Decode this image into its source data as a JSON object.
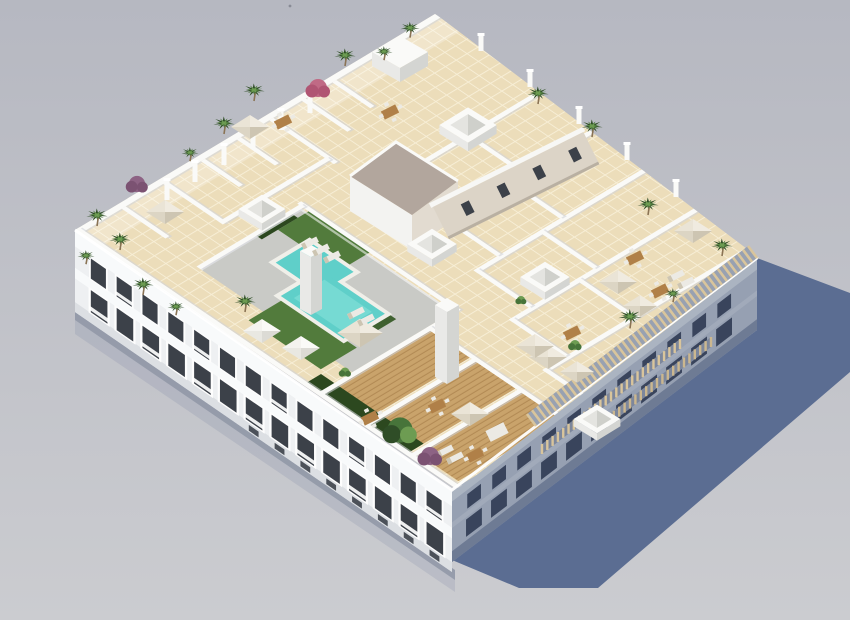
{
  "scene": {
    "title": "Aerial 3D architectural rendering of a white apartment building with rooftop terraces, swimming pool, lawns, palm trees and parasols casting a long shadow",
    "view": "isometric aerial",
    "building_type": "residential apartment block with rooftop pool deck"
  },
  "colors": {
    "bg_top": "#b6b8c1",
    "bg_bottom": "#cbccd0",
    "shadow": "#5b6d92",
    "contact_shadow": "#8f96a6",
    "facade_white": "#eef0f2",
    "facade_band": "#f8fafb",
    "facade_low": "#dcdfe3",
    "window_dark": "#3c4149",
    "window_frame": "#fdfdfd",
    "railing": "#ffffff",
    "facade_right": "#96a0b2",
    "facade_right_band": "#abb4c1",
    "facade_right_low": "#6e7b94",
    "window_right": "#39445c",
    "tile": "#ecddba",
    "tile_line": "#f7eed6",
    "deck_gray": "#c9cac6",
    "wood": "#c9a36b",
    "wood_line": "#b28a54",
    "gravel": "#b2a69d",
    "wall_white": "#fafaf8",
    "wall_shadow": "#d2d4d8",
    "pool": "#5fcfc9",
    "pool_light": "#7eded6",
    "pool_edge": "#f0efe9",
    "lawn": "#527b3c",
    "lawn_dark": "#3f6130",
    "hedge": "#2c481f",
    "palm_dark": "#2f4d27",
    "palm_mid": "#47743a",
    "palm_light": "#6d9c52",
    "magenta": "#b05573",
    "purple": "#7b5272",
    "trunk": "#8a7354",
    "umbrella_light": "#eae4d6",
    "umbrella_lighter": "#f0ebe0",
    "umbrella_dark": "#cdc5b2",
    "umbrella_mid": "#dcd5c4",
    "umbrella_white1": "#f4f3ef",
    "umbrella_white2": "#fafaf7",
    "umbrella_white3": "#dcdbd5",
    "umbrella_white4": "#e9e8e2",
    "pergola": "#d9c59c",
    "pergola_gap": "#98a1b1",
    "core_wall": "#dcd4c7",
    "core_wall_sw": "#f3f3f1",
    "core_wall_se": "#e2dbd0",
    "table_wood": "#b08048",
    "furniture_white": "#eceae4",
    "chimney_light": "#e9e9e7",
    "chimney_dark": "#d4d5d2"
  }
}
